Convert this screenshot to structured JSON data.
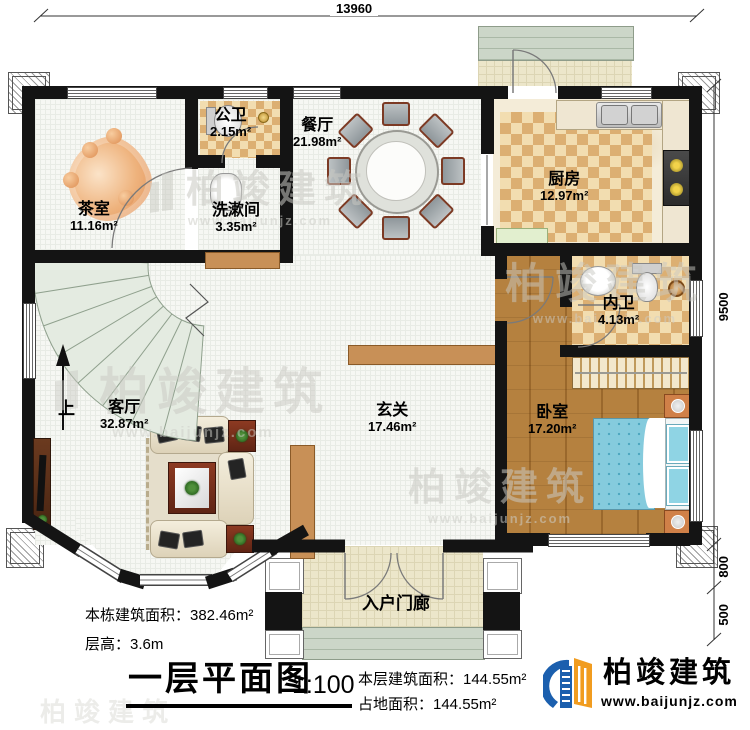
{
  "drawing": {
    "title": "一层平面图",
    "scale": "1:100"
  },
  "stats": {
    "building_total_area": "本栋建筑面积：382.46m²",
    "floor_height": "层高：3.6m",
    "floor_area": "本层建筑面积：144.55m²",
    "land_area": "占地面积：144.55m²"
  },
  "dimensions": {
    "top_width": "13960",
    "right_main": "9500",
    "right_porch": "800",
    "right_steps": "500"
  },
  "rooms": {
    "tea_room": {
      "name": "茶室",
      "area": "11.16m²"
    },
    "public_wc": {
      "name": "公卫",
      "area": "2.15m²"
    },
    "wash_room": {
      "name": "洗漱间",
      "area": "3.35m²"
    },
    "dining": {
      "name": "餐厅",
      "area": "21.98m²"
    },
    "kitchen": {
      "name": "厨房",
      "area": "12.97m²"
    },
    "inner_wc": {
      "name": "内卫",
      "area": "4.13m²"
    },
    "living": {
      "name": "客厅",
      "area": "32.87m²"
    },
    "foyer": {
      "name": "玄关",
      "area": "17.46m²"
    },
    "bedroom": {
      "name": "卧室",
      "area": "17.20m²"
    },
    "entry_porch": {
      "name": "入户门廊"
    }
  },
  "stairs": {
    "up_label": "上"
  },
  "brand": {
    "name": "柏竣建筑",
    "website": "www.baijunjz.com"
  },
  "watermark": {
    "text": "柏竣建筑",
    "url": "www.baijunjz.com"
  },
  "colors": {
    "wall": "#141414",
    "checker_dark": "#dcaf72",
    "checker_light": "#f2ddb0",
    "wood": "#b5813f",
    "bed": "#85cbdd",
    "brand_blue": "#1b5fae",
    "brand_orange": "#f19c1f"
  }
}
